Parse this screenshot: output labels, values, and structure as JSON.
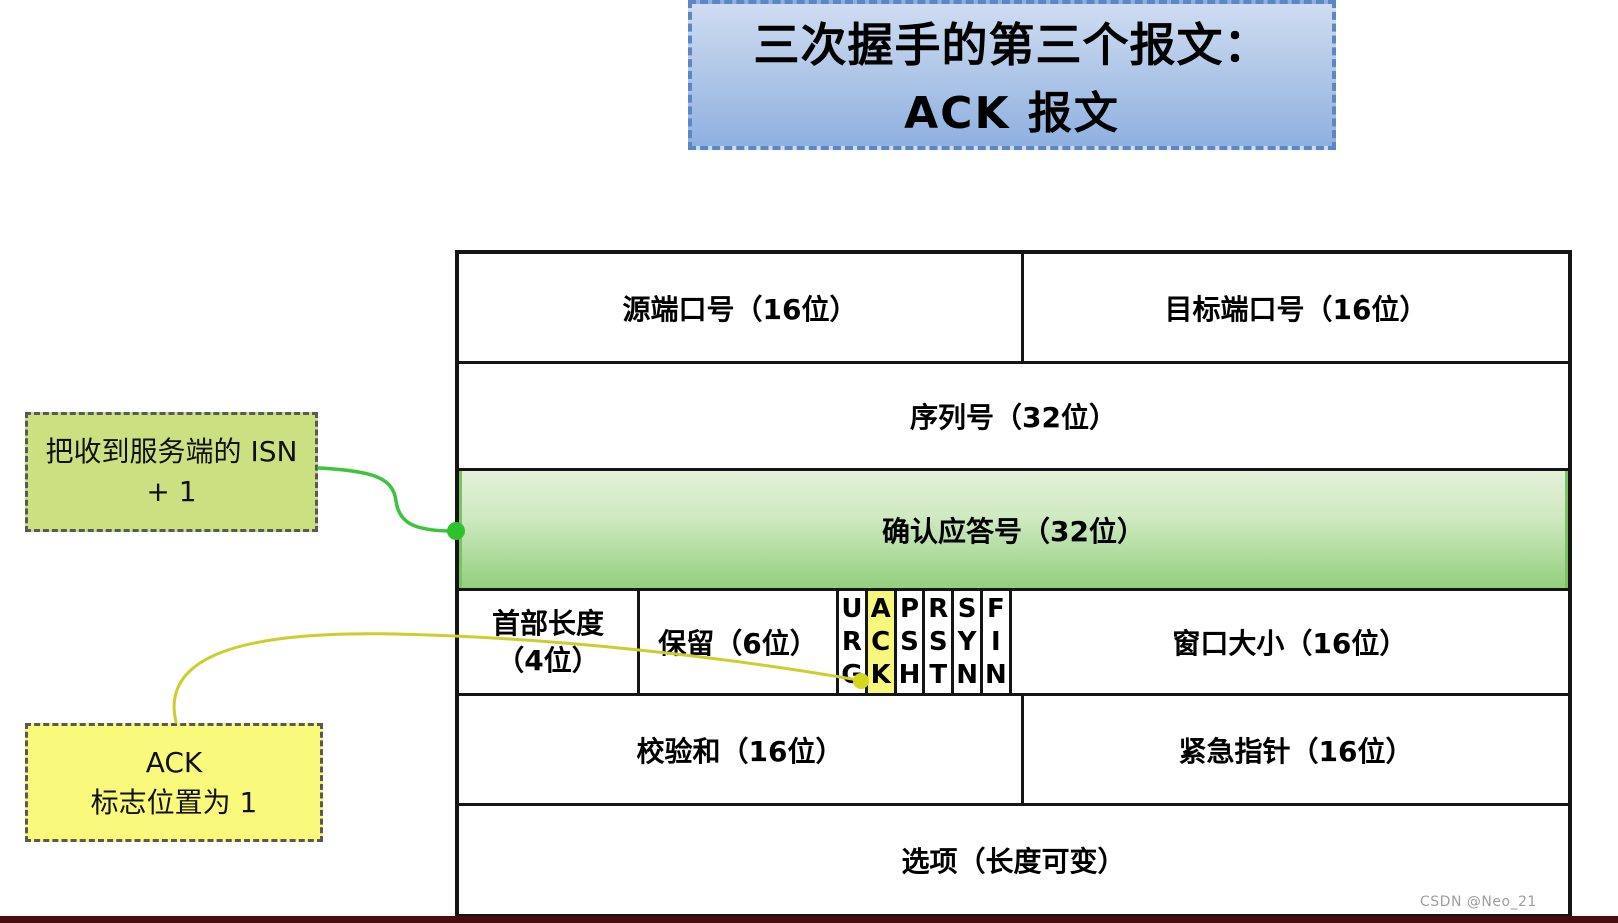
{
  "title_box": {
    "line1": "三次握手的第三个报文：",
    "line2": "ACK 报文"
  },
  "annotations": {
    "isn_note": {
      "line1": "把收到服务端的 ISN",
      "line2": "+ 1"
    },
    "ack_note": {
      "line1": "ACK",
      "line2": "标志位置为 1"
    }
  },
  "tcp_header": {
    "source_port": "源端口号（16位）",
    "dest_port": "目标端口号（16位）",
    "sequence": "序列号（32位）",
    "ack_number": "确认应答号（32位）",
    "header_length_line1": "首部长度",
    "header_length_line2": "（4位）",
    "reserved": "保留（6位）",
    "flags": [
      {
        "label": "URG",
        "highlighted": false
      },
      {
        "label": "ACK",
        "highlighted": true
      },
      {
        "label": "PSH",
        "highlighted": false
      },
      {
        "label": "RST",
        "highlighted": false
      },
      {
        "label": "SYN",
        "highlighted": false
      },
      {
        "label": "FIN",
        "highlighted": false
      }
    ],
    "window": "窗口大小（16位）",
    "checksum": "校验和（16位）",
    "urgent_pointer": "紧急指针（16位）",
    "options": "选项（长度可变）"
  },
  "watermark": "CSDN @Neo_21",
  "colors": {
    "title_fill_top": "#cfdcf2",
    "title_fill_bottom": "#8fb0e0",
    "title_border": "#5d87c4",
    "ack_row_fill_bottom": "#93cf7f",
    "isn_note_fill": "#cbe181",
    "ack_note_fill": "#f9f97b",
    "ack_flag_fill": "#f7f77c",
    "green_connector": "#3cc43c",
    "yellow_connector": "#ccce2e",
    "table_border": "#151515",
    "bottom_bar": "#480d0d",
    "watermark_gray": "#9e9e9e"
  }
}
